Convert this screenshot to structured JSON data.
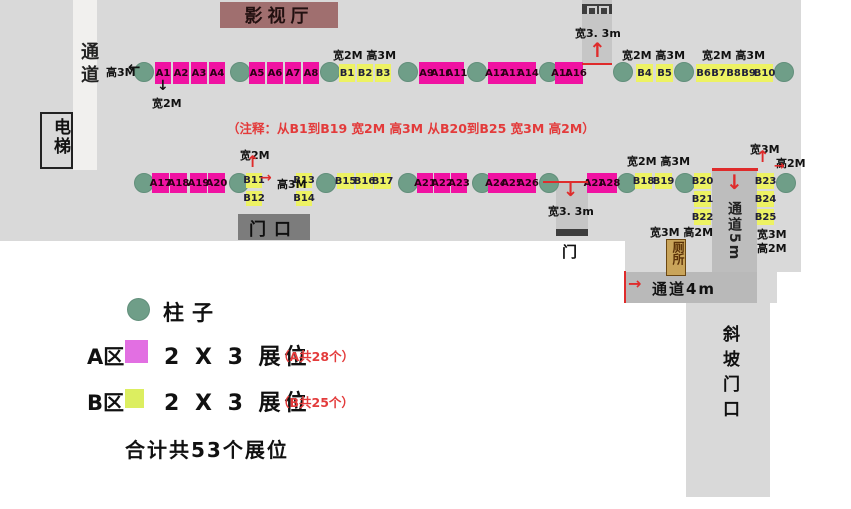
{
  "areas": {
    "cinema": "影视厅",
    "doorway": "门口",
    "elevator": "电梯",
    "corridor_left": "通道",
    "door_top": "门",
    "door_mid": "门",
    "toilet": "厕所",
    "corridor_5m": "通道5m",
    "passage_4m": "通道4m",
    "ramp": "斜坡门口"
  },
  "note": "（注释：从B1到B19 宽2M 高3M   从B20到B25 宽3M 高2M）",
  "legend": {
    "pillar_label": "柱子",
    "zone_a_prefix": "A区",
    "zone_a_label": "2 X 3 展位",
    "zone_a_count": "（A共28个）",
    "zone_b_prefix": "B区",
    "zone_b_label": "2 X 3 展位",
    "zone_b_count": "（B共25个）",
    "total": "合计共53个展位"
  },
  "colors": {
    "floor": "#d9d9d9",
    "corridor_light": "#f1f0ee",
    "corridor_dark": "#bdbdbd",
    "booth_a": "#f012a2",
    "booth_b": "#edf263",
    "legend_a": "#e26fe2",
    "legend_b": "#dcee60",
    "pillar": "#6f9e88",
    "cinema_bg": "#a06f6f",
    "doorbox_bg": "#7c7c7c",
    "toilet_bg": "#c9a45a",
    "accent_red": "#df2b2b"
  },
  "plan": {
    "pillars": [
      [
        134,
        62
      ],
      [
        230,
        62
      ],
      [
        320,
        62
      ],
      [
        398,
        62
      ],
      [
        467,
        62
      ],
      [
        539,
        62
      ],
      [
        613,
        62
      ],
      [
        674,
        62
      ],
      [
        774,
        62
      ],
      [
        134,
        173
      ],
      [
        229,
        173
      ],
      [
        316,
        173
      ],
      [
        398,
        173
      ],
      [
        472,
        173
      ],
      [
        539,
        173
      ],
      [
        617,
        173
      ],
      [
        675,
        173
      ],
      [
        776,
        173
      ]
    ],
    "booths": [
      {
        "id": "A1",
        "z": "A",
        "x": 155,
        "y": 62,
        "w": 16,
        "h": 22
      },
      {
        "id": "A2",
        "z": "A",
        "x": 173,
        "y": 62,
        "w": 16,
        "h": 22
      },
      {
        "id": "A3",
        "z": "A",
        "x": 191,
        "y": 62,
        "w": 16,
        "h": 22
      },
      {
        "id": "A4",
        "z": "A",
        "x": 209,
        "y": 62,
        "w": 16,
        "h": 22
      },
      {
        "id": "A5",
        "z": "A",
        "x": 249,
        "y": 62,
        "w": 16,
        "h": 22
      },
      {
        "id": "A6",
        "z": "A",
        "x": 267,
        "y": 62,
        "w": 16,
        "h": 22
      },
      {
        "id": "A7",
        "z": "A",
        "x": 285,
        "y": 62,
        "w": 16,
        "h": 22
      },
      {
        "id": "A8",
        "z": "A",
        "x": 303,
        "y": 62,
        "w": 16,
        "h": 22
      },
      {
        "id": "B1",
        "z": "B",
        "x": 339,
        "y": 64,
        "w": 16,
        "h": 18
      },
      {
        "id": "B2",
        "z": "B",
        "x": 357,
        "y": 64,
        "w": 16,
        "h": 18
      },
      {
        "id": "B3",
        "z": "B",
        "x": 375,
        "y": 64,
        "w": 16,
        "h": 18
      },
      {
        "id": "A9",
        "z": "A",
        "x": 419,
        "y": 62,
        "w": 15,
        "h": 22
      },
      {
        "id": "A10",
        "z": "A",
        "x": 434,
        "y": 62,
        "w": 15,
        "h": 22
      },
      {
        "id": "A11",
        "z": "A",
        "x": 449,
        "y": 62,
        "w": 15,
        "h": 22
      },
      {
        "id": "A12",
        "z": "A",
        "x": 488,
        "y": 62,
        "w": 16,
        "h": 22
      },
      {
        "id": "A13",
        "z": "A",
        "x": 504,
        "y": 62,
        "w": 16,
        "h": 22
      },
      {
        "id": "A14",
        "z": "A",
        "x": 520,
        "y": 62,
        "w": 16,
        "h": 22
      },
      {
        "id": "A15",
        "z": "A",
        "x": 555,
        "y": 62,
        "w": 14,
        "h": 22
      },
      {
        "id": "A16",
        "z": "A",
        "x": 569,
        "y": 62,
        "w": 14,
        "h": 22
      },
      {
        "id": "B4",
        "z": "B",
        "x": 636,
        "y": 64,
        "w": 17,
        "h": 18
      },
      {
        "id": "B5",
        "z": "B",
        "x": 656,
        "y": 64,
        "w": 17,
        "h": 18
      },
      {
        "id": "B6",
        "z": "B",
        "x": 696,
        "y": 64,
        "w": 15,
        "h": 18
      },
      {
        "id": "B7",
        "z": "B",
        "x": 711,
        "y": 64,
        "w": 15,
        "h": 18
      },
      {
        "id": "B8",
        "z": "B",
        "x": 726,
        "y": 64,
        "w": 15,
        "h": 18
      },
      {
        "id": "B9",
        "z": "B",
        "x": 741,
        "y": 64,
        "w": 15,
        "h": 18
      },
      {
        "id": "B10",
        "z": "B",
        "x": 756,
        "y": 64,
        "w": 17,
        "h": 18
      },
      {
        "id": "A17",
        "z": "A",
        "x": 152,
        "y": 173,
        "w": 17,
        "h": 20
      },
      {
        "id": "A18",
        "z": "A",
        "x": 170,
        "y": 173,
        "w": 17,
        "h": 20
      },
      {
        "id": "A19",
        "z": "A",
        "x": 190,
        "y": 173,
        "w": 17,
        "h": 20
      },
      {
        "id": "A20",
        "z": "A",
        "x": 208,
        "y": 173,
        "w": 17,
        "h": 20
      },
      {
        "id": "B11",
        "z": "B",
        "x": 246,
        "y": 173,
        "w": 16,
        "h": 15
      },
      {
        "id": "B12",
        "z": "B",
        "x": 246,
        "y": 191,
        "w": 16,
        "h": 15
      },
      {
        "id": "B13",
        "z": "B",
        "x": 296,
        "y": 173,
        "w": 16,
        "h": 15
      },
      {
        "id": "B14",
        "z": "B",
        "x": 296,
        "y": 191,
        "w": 16,
        "h": 15
      },
      {
        "id": "B15",
        "z": "B",
        "x": 337,
        "y": 173,
        "w": 17,
        "h": 16
      },
      {
        "id": "B16",
        "z": "B",
        "x": 356,
        "y": 173,
        "w": 17,
        "h": 16
      },
      {
        "id": "B17",
        "z": "B",
        "x": 374,
        "y": 173,
        "w": 17,
        "h": 16
      },
      {
        "id": "A21",
        "z": "A",
        "x": 417,
        "y": 173,
        "w": 16,
        "h": 20
      },
      {
        "id": "A22",
        "z": "A",
        "x": 434,
        "y": 173,
        "w": 16,
        "h": 20
      },
      {
        "id": "A23",
        "z": "A",
        "x": 451,
        "y": 173,
        "w": 16,
        "h": 20
      },
      {
        "id": "A24",
        "z": "A",
        "x": 488,
        "y": 173,
        "w": 16,
        "h": 20
      },
      {
        "id": "A25",
        "z": "A",
        "x": 504,
        "y": 173,
        "w": 16,
        "h": 20
      },
      {
        "id": "A26",
        "z": "A",
        "x": 520,
        "y": 173,
        "w": 16,
        "h": 20
      },
      {
        "id": "A27",
        "z": "A",
        "x": 587,
        "y": 173,
        "w": 15,
        "h": 20
      },
      {
        "id": "A28",
        "z": "A",
        "x": 602,
        "y": 173,
        "w": 15,
        "h": 20
      },
      {
        "id": "B18",
        "z": "B",
        "x": 635,
        "y": 173,
        "w": 17,
        "h": 16
      },
      {
        "id": "B19",
        "z": "B",
        "x": 655,
        "y": 173,
        "w": 17,
        "h": 16
      },
      {
        "id": "B20",
        "z": "B",
        "x": 694,
        "y": 173,
        "w": 17,
        "h": 16
      },
      {
        "id": "B21",
        "z": "B",
        "x": 694,
        "y": 191,
        "w": 17,
        "h": 16
      },
      {
        "id": "B22",
        "z": "B",
        "x": 694,
        "y": 209,
        "w": 17,
        "h": 16
      },
      {
        "id": "B23",
        "z": "B",
        "x": 757,
        "y": 173,
        "w": 17,
        "h": 16
      },
      {
        "id": "B24",
        "z": "B",
        "x": 757,
        "y": 191,
        "w": 17,
        "h": 16
      },
      {
        "id": "B25",
        "z": "B",
        "x": 757,
        "y": 209,
        "w": 17,
        "h": 16
      }
    ],
    "dim_labels": [
      {
        "text": "高3M",
        "x": 106,
        "y": 64
      },
      {
        "text": "宽2M",
        "x": 152,
        "y": 95
      },
      {
        "text": "宽2M  高3M",
        "x": 333,
        "y": 47
      },
      {
        "text": "宽3. 3m",
        "x": 575,
        "y": 25
      },
      {
        "text": "宽2M  高3M",
        "x": 622,
        "y": 47
      },
      {
        "text": "宽2M  高3M",
        "x": 702,
        "y": 47
      },
      {
        "text": "宽2M",
        "x": 240,
        "y": 147
      },
      {
        "text": "高3M",
        "x": 277,
        "y": 176
      },
      {
        "text": "宽3. 3m",
        "x": 548,
        "y": 203
      },
      {
        "text": "宽2M  高3M",
        "x": 627,
        "y": 153
      },
      {
        "text": "宽3M",
        "x": 750,
        "y": 141
      },
      {
        "text": "高2M",
        "x": 776,
        "y": 155
      },
      {
        "text": "宽3M  高2M",
        "x": 650,
        "y": 224
      },
      {
        "text": "宽3M",
        "x": 757,
        "y": 226
      },
      {
        "text": "高2M",
        "x": 757,
        "y": 240
      }
    ],
    "arrows": [
      {
        "ch": "←",
        "x": 128,
        "y": 60,
        "c": "k",
        "s": 15
      },
      {
        "ch": "↓",
        "x": 157,
        "y": 79,
        "c": "k",
        "s": 14
      },
      {
        "ch": "↑",
        "x": 589,
        "y": 40,
        "c": "r",
        "s": 20
      },
      {
        "ch": "↑",
        "x": 246,
        "y": 154,
        "c": "r",
        "s": 16
      },
      {
        "ch": "→",
        "x": 260,
        "y": 171,
        "c": "r",
        "s": 14
      },
      {
        "ch": "↓",
        "x": 563,
        "y": 182,
        "c": "r",
        "s": 18
      },
      {
        "ch": "↓",
        "x": 726,
        "y": 172,
        "c": "r",
        "s": 20
      },
      {
        "ch": "↑",
        "x": 756,
        "y": 149,
        "c": "r",
        "s": 16
      },
      {
        "ch": "→",
        "x": 774,
        "y": 160,
        "c": "r",
        "s": 13
      },
      {
        "ch": "→",
        "x": 628,
        "y": 276,
        "c": "r",
        "s": 16
      }
    ],
    "red_lines": [
      {
        "x": 582,
        "y": 63,
        "w": 30,
        "h": 2
      },
      {
        "x": 543,
        "y": 181,
        "w": 45,
        "h": 2
      },
      {
        "x": 712,
        "y": 168,
        "w": 46,
        "h": 3
      },
      {
        "x": 624,
        "y": 271,
        "w": 2,
        "h": 32
      }
    ]
  }
}
